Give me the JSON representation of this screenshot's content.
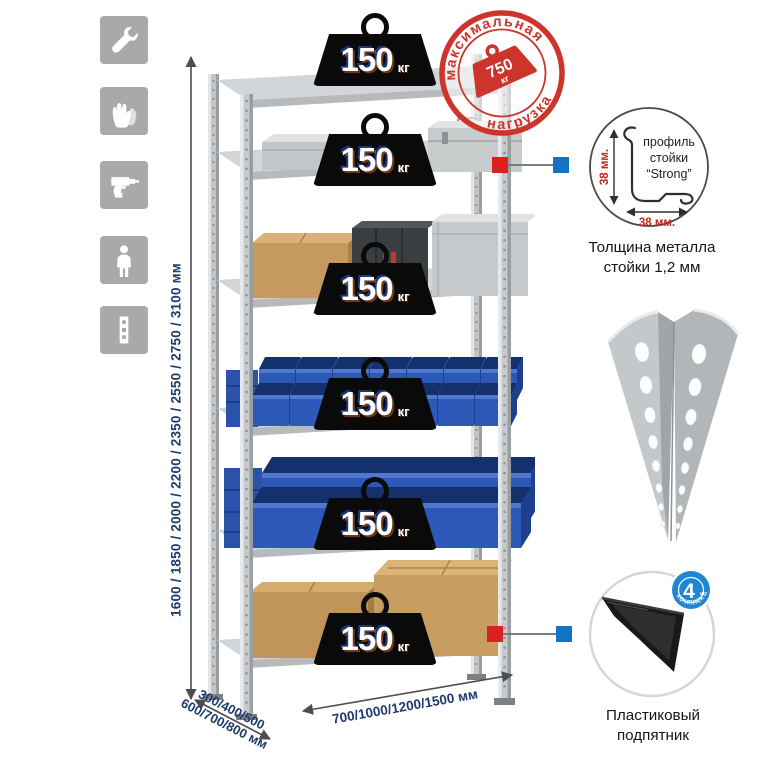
{
  "sidebar": {
    "icons": [
      {
        "name": "wrench-icon"
      },
      {
        "name": "gloves-icon"
      },
      {
        "name": "drill-icon"
      },
      {
        "name": "person-icon"
      },
      {
        "name": "perforated-post-icon"
      }
    ]
  },
  "dimensions": {
    "height": "1600 / 1850 / 2000 / 2200 / 2350 / 2550 / 2750 / 3100 мм",
    "depth_line1": "300/400/500",
    "depth_line2": "600/700/800 мм",
    "width": "700/1000/1200/1500 мм"
  },
  "max_load_stamp": {
    "arc_top": "максимальная",
    "arc_bottom": "нагрузка",
    "value": "750",
    "unit": "кг"
  },
  "shelf_weights": [
    {
      "value": "150",
      "unit": "кг"
    },
    {
      "value": "150",
      "unit": "кг"
    },
    {
      "value": "150",
      "unit": "кг"
    },
    {
      "value": "150",
      "unit": "кг"
    },
    {
      "value": "150",
      "unit": "кг"
    },
    {
      "value": "150",
      "unit": "кг"
    }
  ],
  "profile_callout": {
    "label_line1": "профиль",
    "label_line2": "стойки",
    "label_line3": "“Strong”",
    "dim_vertical": "38 мм.",
    "dim_horizontal": "38 мм.",
    "caption": "Толщина металла стойки 1,2 мм"
  },
  "foot_callout": {
    "badge_number": "4",
    "badge_unit": "шт",
    "badge_arc": "В КОМПЛЕКТЕ",
    "caption": "Пластиковый подпятник"
  },
  "colors": {
    "stamp_red": "#cd352c",
    "marker_red": "#dd2020",
    "marker_blue": "#1273c4",
    "navy_text": "#1e3a6e",
    "bin_blue": "#2e58b8"
  }
}
